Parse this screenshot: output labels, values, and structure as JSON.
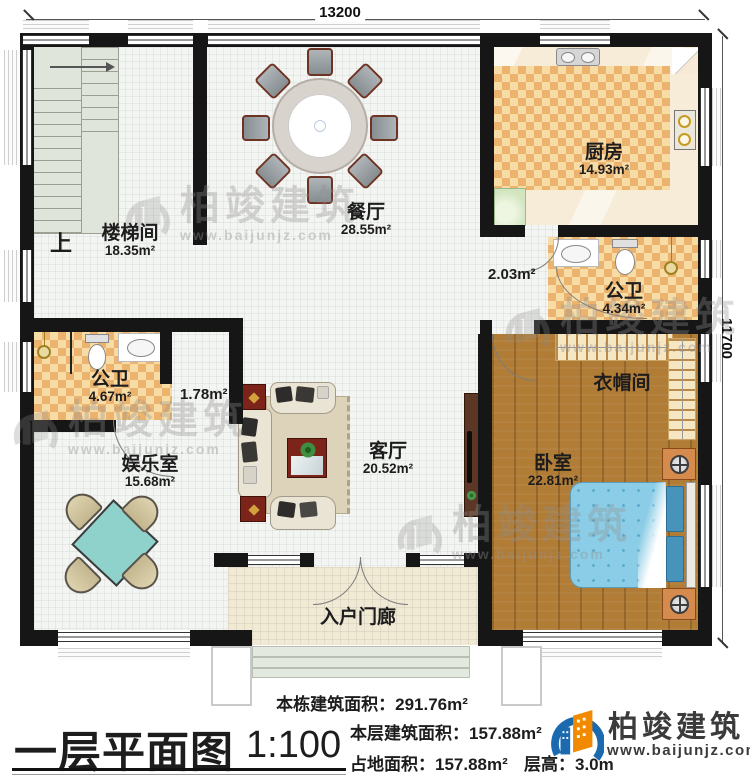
{
  "dimensions": {
    "width_label": "13200",
    "height_label": "11700"
  },
  "rooms": {
    "stairwell": {
      "name": "楼梯间",
      "area": "18.35m²",
      "up": "上"
    },
    "dining": {
      "name": "餐厅",
      "area": "28.55m²"
    },
    "kitchen": {
      "name": "厨房",
      "area": "14.93m²"
    },
    "bath_right": {
      "name": "公卫",
      "area": "4.34m²"
    },
    "hall_right": {
      "area": "2.03m²"
    },
    "cloakroom": {
      "name": "衣帽间"
    },
    "bedroom": {
      "name": "卧室",
      "area": "22.81m²"
    },
    "bath_left": {
      "name": "公卫",
      "area": "4.67m²"
    },
    "hall_left": {
      "area": "1.78m²"
    },
    "entertainment": {
      "name": "娱乐室",
      "area": "15.68m²"
    },
    "living": {
      "name": "客厅",
      "area": "20.52m²"
    },
    "porch": {
      "name": "入户门廊"
    }
  },
  "title_block": {
    "title": "一层平面图",
    "scale": "1:100",
    "building_area": "本栋建筑面积：291.76m²",
    "floor_area": "本层建筑面积：157.88m²",
    "land_area": "占地面积：157.88m²",
    "floor_height": "层高：3.0m"
  },
  "branding": {
    "name": "柏竣建筑",
    "website": "www.baijunjz.com"
  },
  "colors": {
    "wall": "#161616",
    "checker_floor": "#ecb36f",
    "wood_floor": "#b07c36",
    "bed": "#8bcde6",
    "stairs": "#dfe5da",
    "logo_blue": "#1b6ab0",
    "logo_orange": "#f28a00"
  }
}
